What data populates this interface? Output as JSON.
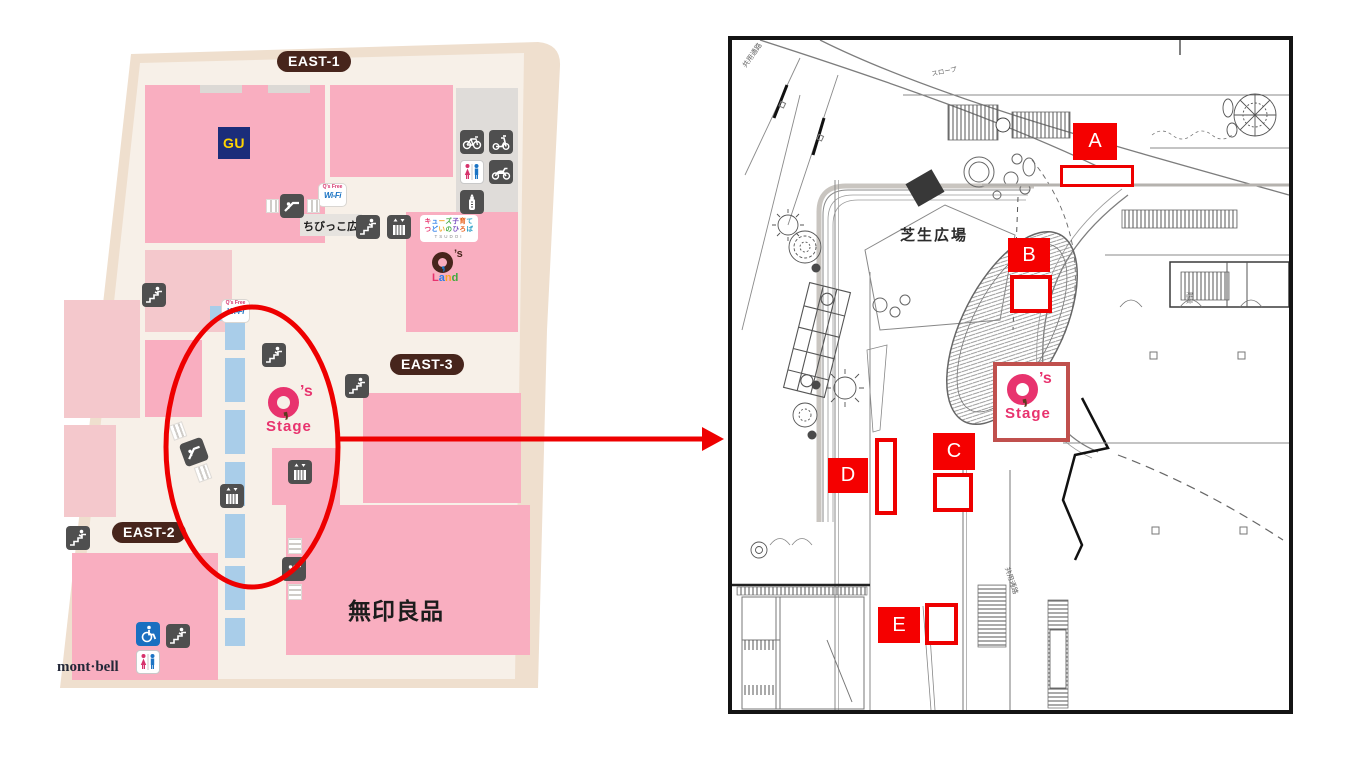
{
  "left_map": {
    "badges": {
      "east1": "EAST-1",
      "east2": "EAST-2",
      "east3": "EAST-3"
    },
    "gu": "GU",
    "muji": "無印良品",
    "montbell": "mont·bell",
    "chibikko": "ちびっこ広場",
    "tsudoi": {
      "line1": "キューズ子育て",
      "line2": "つどいのひろば",
      "line3": "TSUDOI"
    },
    "qs_land": {
      "apos": "’s",
      "word": "Land"
    },
    "qs_stage": {
      "apos": "’s",
      "word": "Stage"
    },
    "wifi": {
      "top": "Q's Free",
      "bottom": "Wi-Fi"
    }
  },
  "plan": {
    "texts": {
      "lawn_plaza": "芝生広場",
      "slope": "スロープ",
      "shared_corridor_top": "共用通路",
      "shared_corridor_bottom": "共用通路",
      "stairs_room": "階段"
    },
    "markers": [
      {
        "label": "A"
      },
      {
        "label": "B"
      },
      {
        "label": "C"
      },
      {
        "label": "D"
      },
      {
        "label": "E"
      }
    ],
    "qs_stage": {
      "apos": "’s",
      "word": "Stage"
    }
  },
  "colors": {
    "annotation_red": "#EE0000",
    "marker_red": "#F50000",
    "pink": "#F9AEC0",
    "pink_light": "#F4C8CC",
    "beige": "#EFDFCE",
    "corridor": "#F7F0E8",
    "badge_brown": "#47251C",
    "gu_navy": "#1B2D7A",
    "gu_yellow": "#FFD400",
    "stage_pink": "#E8336E",
    "logo_box_border": "#C0504D",
    "wheelchair_blue": "#1A6FC0",
    "path_blue": "#A9CDE9"
  }
}
